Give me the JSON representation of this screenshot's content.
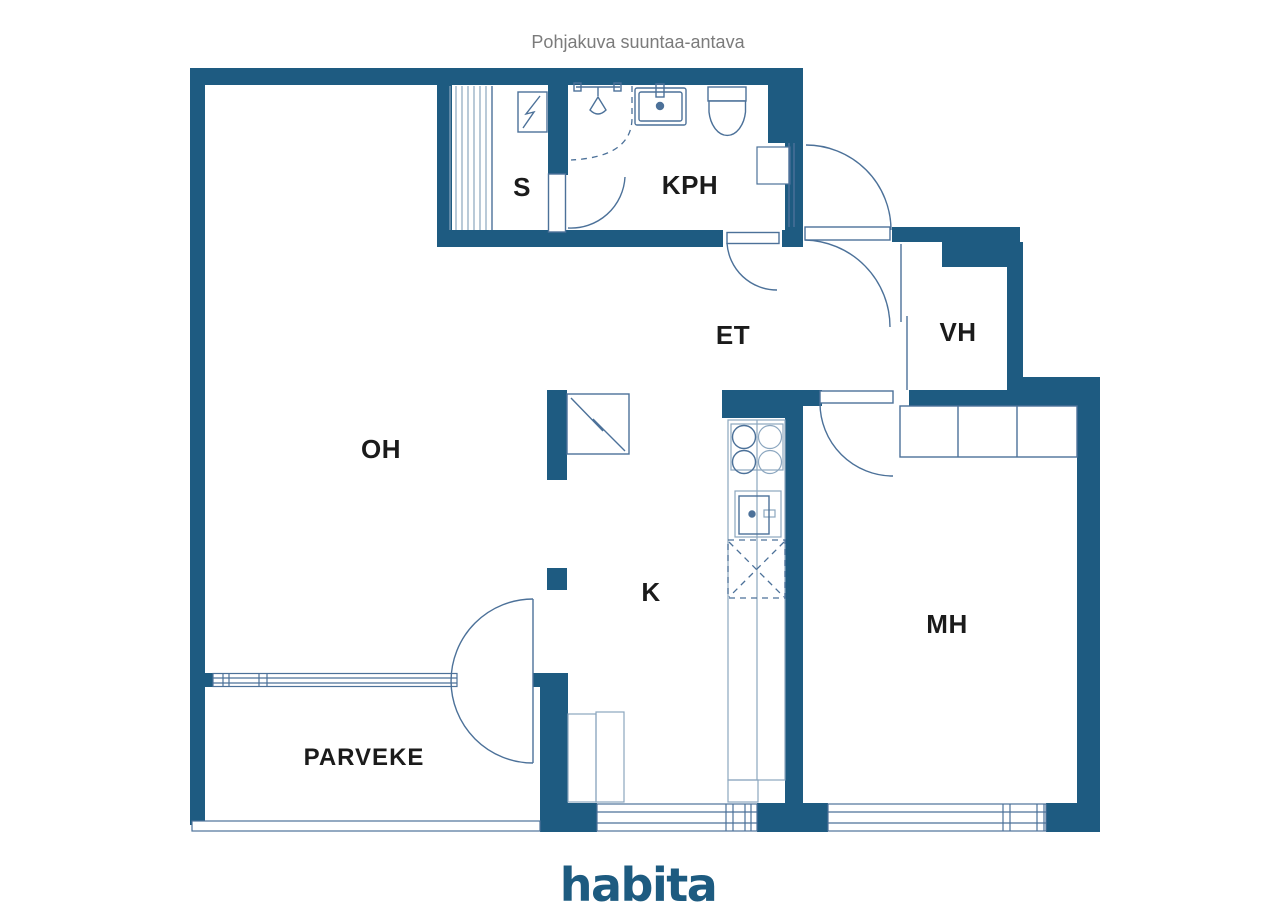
{
  "title": "Pohjakuva suuntaa-antava",
  "brand": "habita",
  "rooms": [
    {
      "name": "sauna",
      "label": "S"
    },
    {
      "name": "bathroom",
      "label": "KPH"
    },
    {
      "name": "hallway",
      "label": "ET"
    },
    {
      "name": "closet",
      "label": "VH"
    },
    {
      "name": "living-room",
      "label": "OH"
    },
    {
      "name": "kitchen",
      "label": "K"
    },
    {
      "name": "bedroom",
      "label": "MH"
    },
    {
      "name": "balcony",
      "label": "PARVEKE"
    }
  ],
  "colors": {
    "wall": "#1e5b81",
    "line": "#4c7199",
    "line_light": "#8ba6bf",
    "label": "#1b1b1b",
    "title": "#7b7b7b",
    "brand": "#1d5b80",
    "background": "#ffffff"
  }
}
